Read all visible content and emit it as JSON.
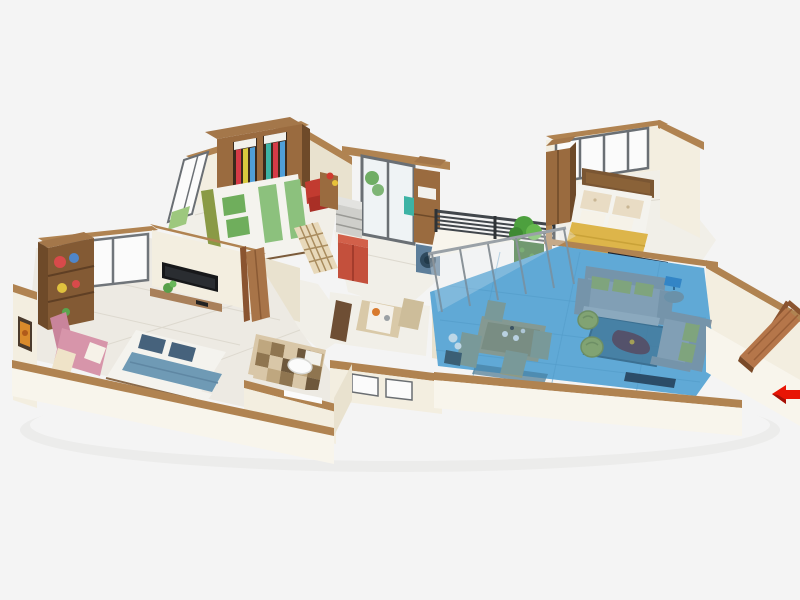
{
  "scene": {
    "type": "isometric-3d-floorplan-render",
    "background": "#f4f4f4",
    "highlighted_room": "living-dining-area",
    "highlight_color": "#4f9fd0",
    "entrance": {
      "marker": "red-arrow",
      "side": "right",
      "direction": "pointing-left-into-door"
    },
    "rooms": [
      {
        "name": "bedroom-top",
        "furniture": [
          "wardrobe-open-doors-with-clothes",
          "double-bed-green",
          "window-panels-west",
          "study-chair-red"
        ]
      },
      {
        "name": "bedroom-left",
        "furniture": [
          "bookshelf-colorful",
          "picture-frame-orange",
          "window-panels-northwest",
          "wall-mounted-tv",
          "floating-desk",
          "desk-plant",
          "chaise-pink",
          "double-bed-blue-white",
          "open-wooden-door"
        ]
      },
      {
        "name": "kitchen-utility",
        "furniture": [
          "glass-sliding-door",
          "plant",
          "tall-wood-cabinet",
          "washing-machine-blue",
          "counter-with-drawers",
          "refrigerator-red",
          "teal-towel",
          "ledge-flower-pot"
        ]
      },
      {
        "name": "hallway",
        "furniture": [
          "lattice-screen",
          "chair-orange"
        ]
      },
      {
        "name": "dining-nook",
        "furniture": [
          "table-with-runner",
          "chair-dark",
          "chair-beige"
        ]
      },
      {
        "name": "bathroom",
        "furniture": [
          "checkered-tile-floor",
          "toilet",
          "white-sill"
        ]
      },
      {
        "name": "balcony",
        "furniture": [
          "dark-slat-railing",
          "vertical-garden",
          "glass-partition"
        ]
      },
      {
        "name": "bedroom-right",
        "furniture": [
          "window-panels-north",
          "wardrobe",
          "double-bed-yellow",
          "patterned-pillows",
          "foot-bench",
          "media-shelf-dark"
        ]
      },
      {
        "name": "living-dining-area",
        "highlighted": true,
        "furniture": [
          "rattan-dining-table",
          "rattan-chairs-4",
          "flower-vase-white",
          "sofa-three-seat-gray",
          "sofa-two-seat-gray",
          "green-accent-cushions",
          "round-side-table",
          "table-lamp-blue",
          "coffee-table-dark-triangle",
          "area-rug-blue",
          "pouf-olive-pair",
          "tv-console-dark"
        ]
      },
      {
        "name": "entry",
        "furniture": [
          "open-wooden-door",
          "entrance-arrow-marker"
        ]
      }
    ]
  },
  "palette": {
    "bg": "#f4f4f4",
    "shadow": "#dedddb",
    "wall": "#f3eee0",
    "walllight": "#f8f5ec",
    "wallshade": "#e9e2cf",
    "cap": "#b08351",
    "wood": "#9a6b3f",
    "wooddark": "#6e4a29",
    "woodlight": "#a4774a",
    "woodside": "#835a34",
    "floor": "#f1efe8",
    "floorline": "#ddd9cf",
    "marble": "#edeae3",
    "glassframe": "#6a6f74",
    "glasspane": "#eef2f4",
    "white": "#fbfbfb",
    "offwhite": "#f2f1ec",
    "red": "#d63b47",
    "darkred": "#a52a30",
    "orange": "#d98a2b",
    "yellow": "#d8c93e",
    "teal": "#3db3a5",
    "plant": "#58a04a",
    "plantdark": "#2f6b2a",
    "plantbright": "#4da03e",
    "bedgreen": "#8cc17d",
    "pillowgreen": "#6fae5c",
    "olive": "#8a9a45",
    "pinksofa": "#d795aa",
    "pinkdark": "#c9849b",
    "cream": "#efe3c8",
    "sheet": "#f4f3ee",
    "denim": "#6f9ab5",
    "denimline": "#5f87a3",
    "navy": "#46627c",
    "tvblack": "#17181a",
    "tvscreen": "#2a2d31",
    "counter": "#cfcfcb",
    "countertop": "#e3e3e0",
    "fridge": "#c4503c",
    "fridgetop": "#d2604a",
    "washer": "#5d7e9a",
    "washerdark": "#2f4a5e",
    "rail": "#41464b",
    "railpost": "#2f3336",
    "bluefloor": "#6cb0d8",
    "blueline": "#5b9fc8",
    "blueoverlay": "#3f96cf",
    "sofagray": "#9aa3ab",
    "sofadark": "#8a939b",
    "sofaseat": "#a8b1b8",
    "cushgreen": "#97a95e",
    "rug": "#47738e",
    "rugline": "#3a617a",
    "pouf": "#9aa84f",
    "poufline": "#7e8c3c",
    "coffeetable": "#5c3844",
    "sidetable": "#7a8f9a",
    "lampblue": "#2e7fc2",
    "console": "#233040",
    "yellowbed": "#ddb54a",
    "yellowline": "#c9a238",
    "pillowcream": "#e9dcc4",
    "pillowwhite": "#f6f2e8",
    "headboard": "#7a5633",
    "headboardlight": "#8a6238",
    "bench": "#3f3a35",
    "doorwood": "#b5764a",
    "dooredge": "#8a5430",
    "doorline": "#9a5f38",
    "arrow": "#e81505",
    "arrowdark": "#a50f05",
    "lattice": "#e8d9ba",
    "latticeline": "#a98c5e",
    "chairorange": "#c9803f",
    "chairorangedark": "#b06a30",
    "tabletop": "#d9c9a8",
    "runner": "#f4f1ea",
    "chairdark": "#6e4e34",
    "chairbeige": "#cdbd9a",
    "rattan": "#a09a7a",
    "rattandark": "#8f8a66",
    "vase": "#eef0f0",
    "vasedark": "#3a4a52",
    "matblue": "#4a7790",
    "tilea": "#d9c7a8",
    "tileb": "#bfa77f",
    "tilec": "#8f7550",
    "tiled": "#6e583c"
  }
}
